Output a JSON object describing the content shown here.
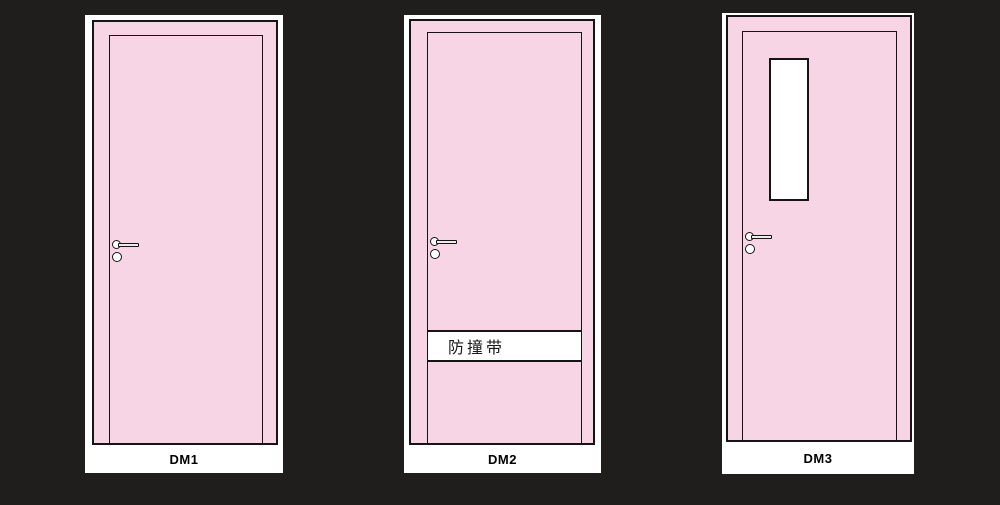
{
  "colors": {
    "background": "#201D1D",
    "door_fill": "#F7D5E5",
    "card_fill": "#FFFFFF",
    "outline": "#161414"
  },
  "doors": [
    {
      "label": "DM1"
    },
    {
      "label": "DM2",
      "band_label": "防撞带"
    },
    {
      "label": "DM3"
    }
  ]
}
